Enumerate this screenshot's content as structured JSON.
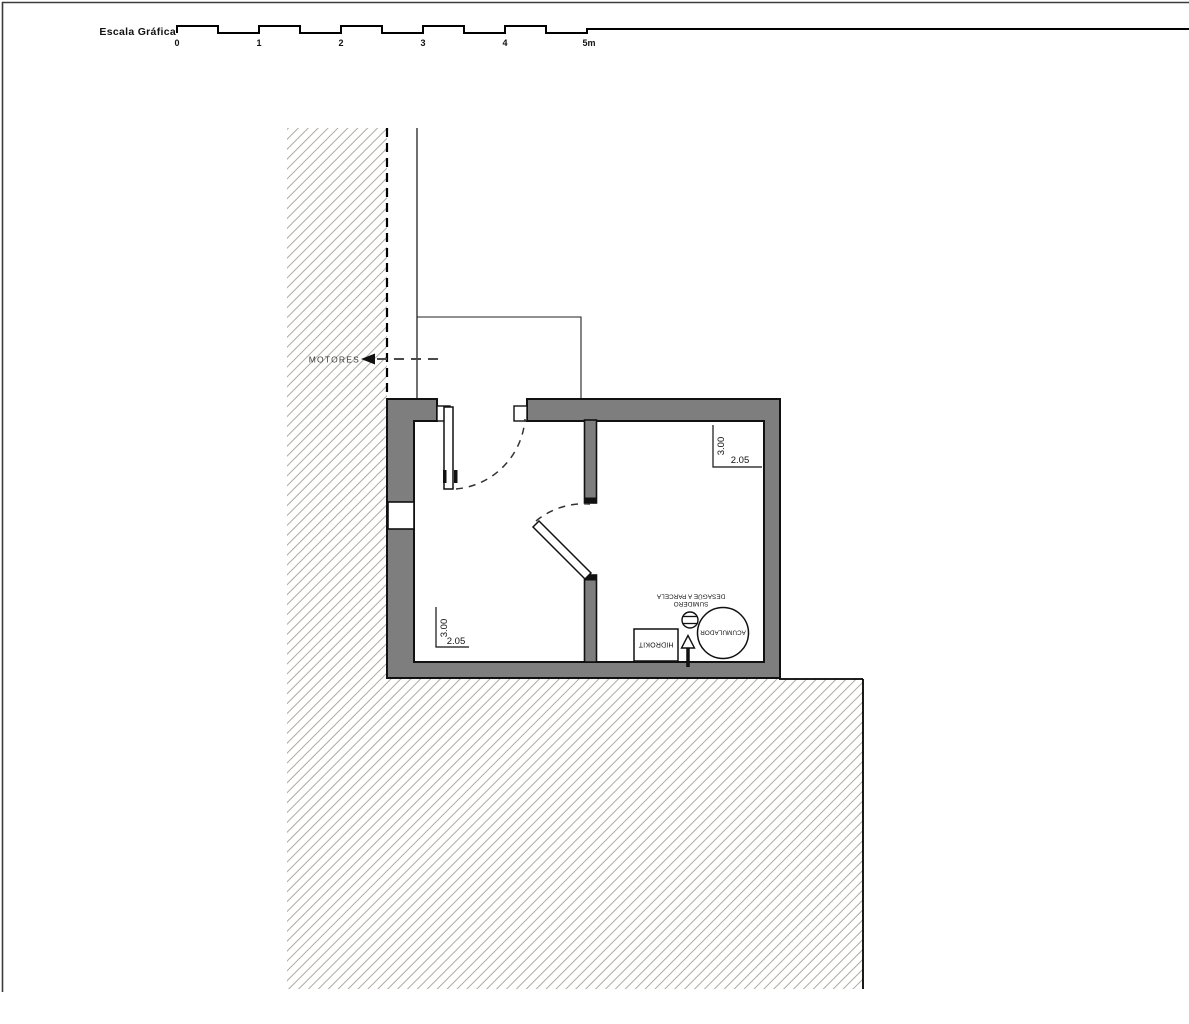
{
  "drawing": {
    "scale_bar": {
      "title": "Escala Gráfica",
      "ticks": [
        "0",
        "1",
        "2",
        "3",
        "4",
        "5m"
      ]
    },
    "annotations": {
      "motores": "MOTORES"
    },
    "rooms": {
      "left": {
        "depth": "3.00",
        "width": "2.05"
      },
      "right": {
        "depth": "3.00",
        "width": "2.05"
      }
    },
    "equipment": {
      "hidrokit": "HIDROKIT",
      "acumulador": "ACUMULADOR",
      "sumidero": {
        "line1": "SUMIDERO",
        "line2": "DESAGÜE A PARCELA"
      }
    }
  },
  "colors": {
    "wall": "#7e7e7e",
    "hatch": "#aeaaa2",
    "line": "#111111"
  }
}
